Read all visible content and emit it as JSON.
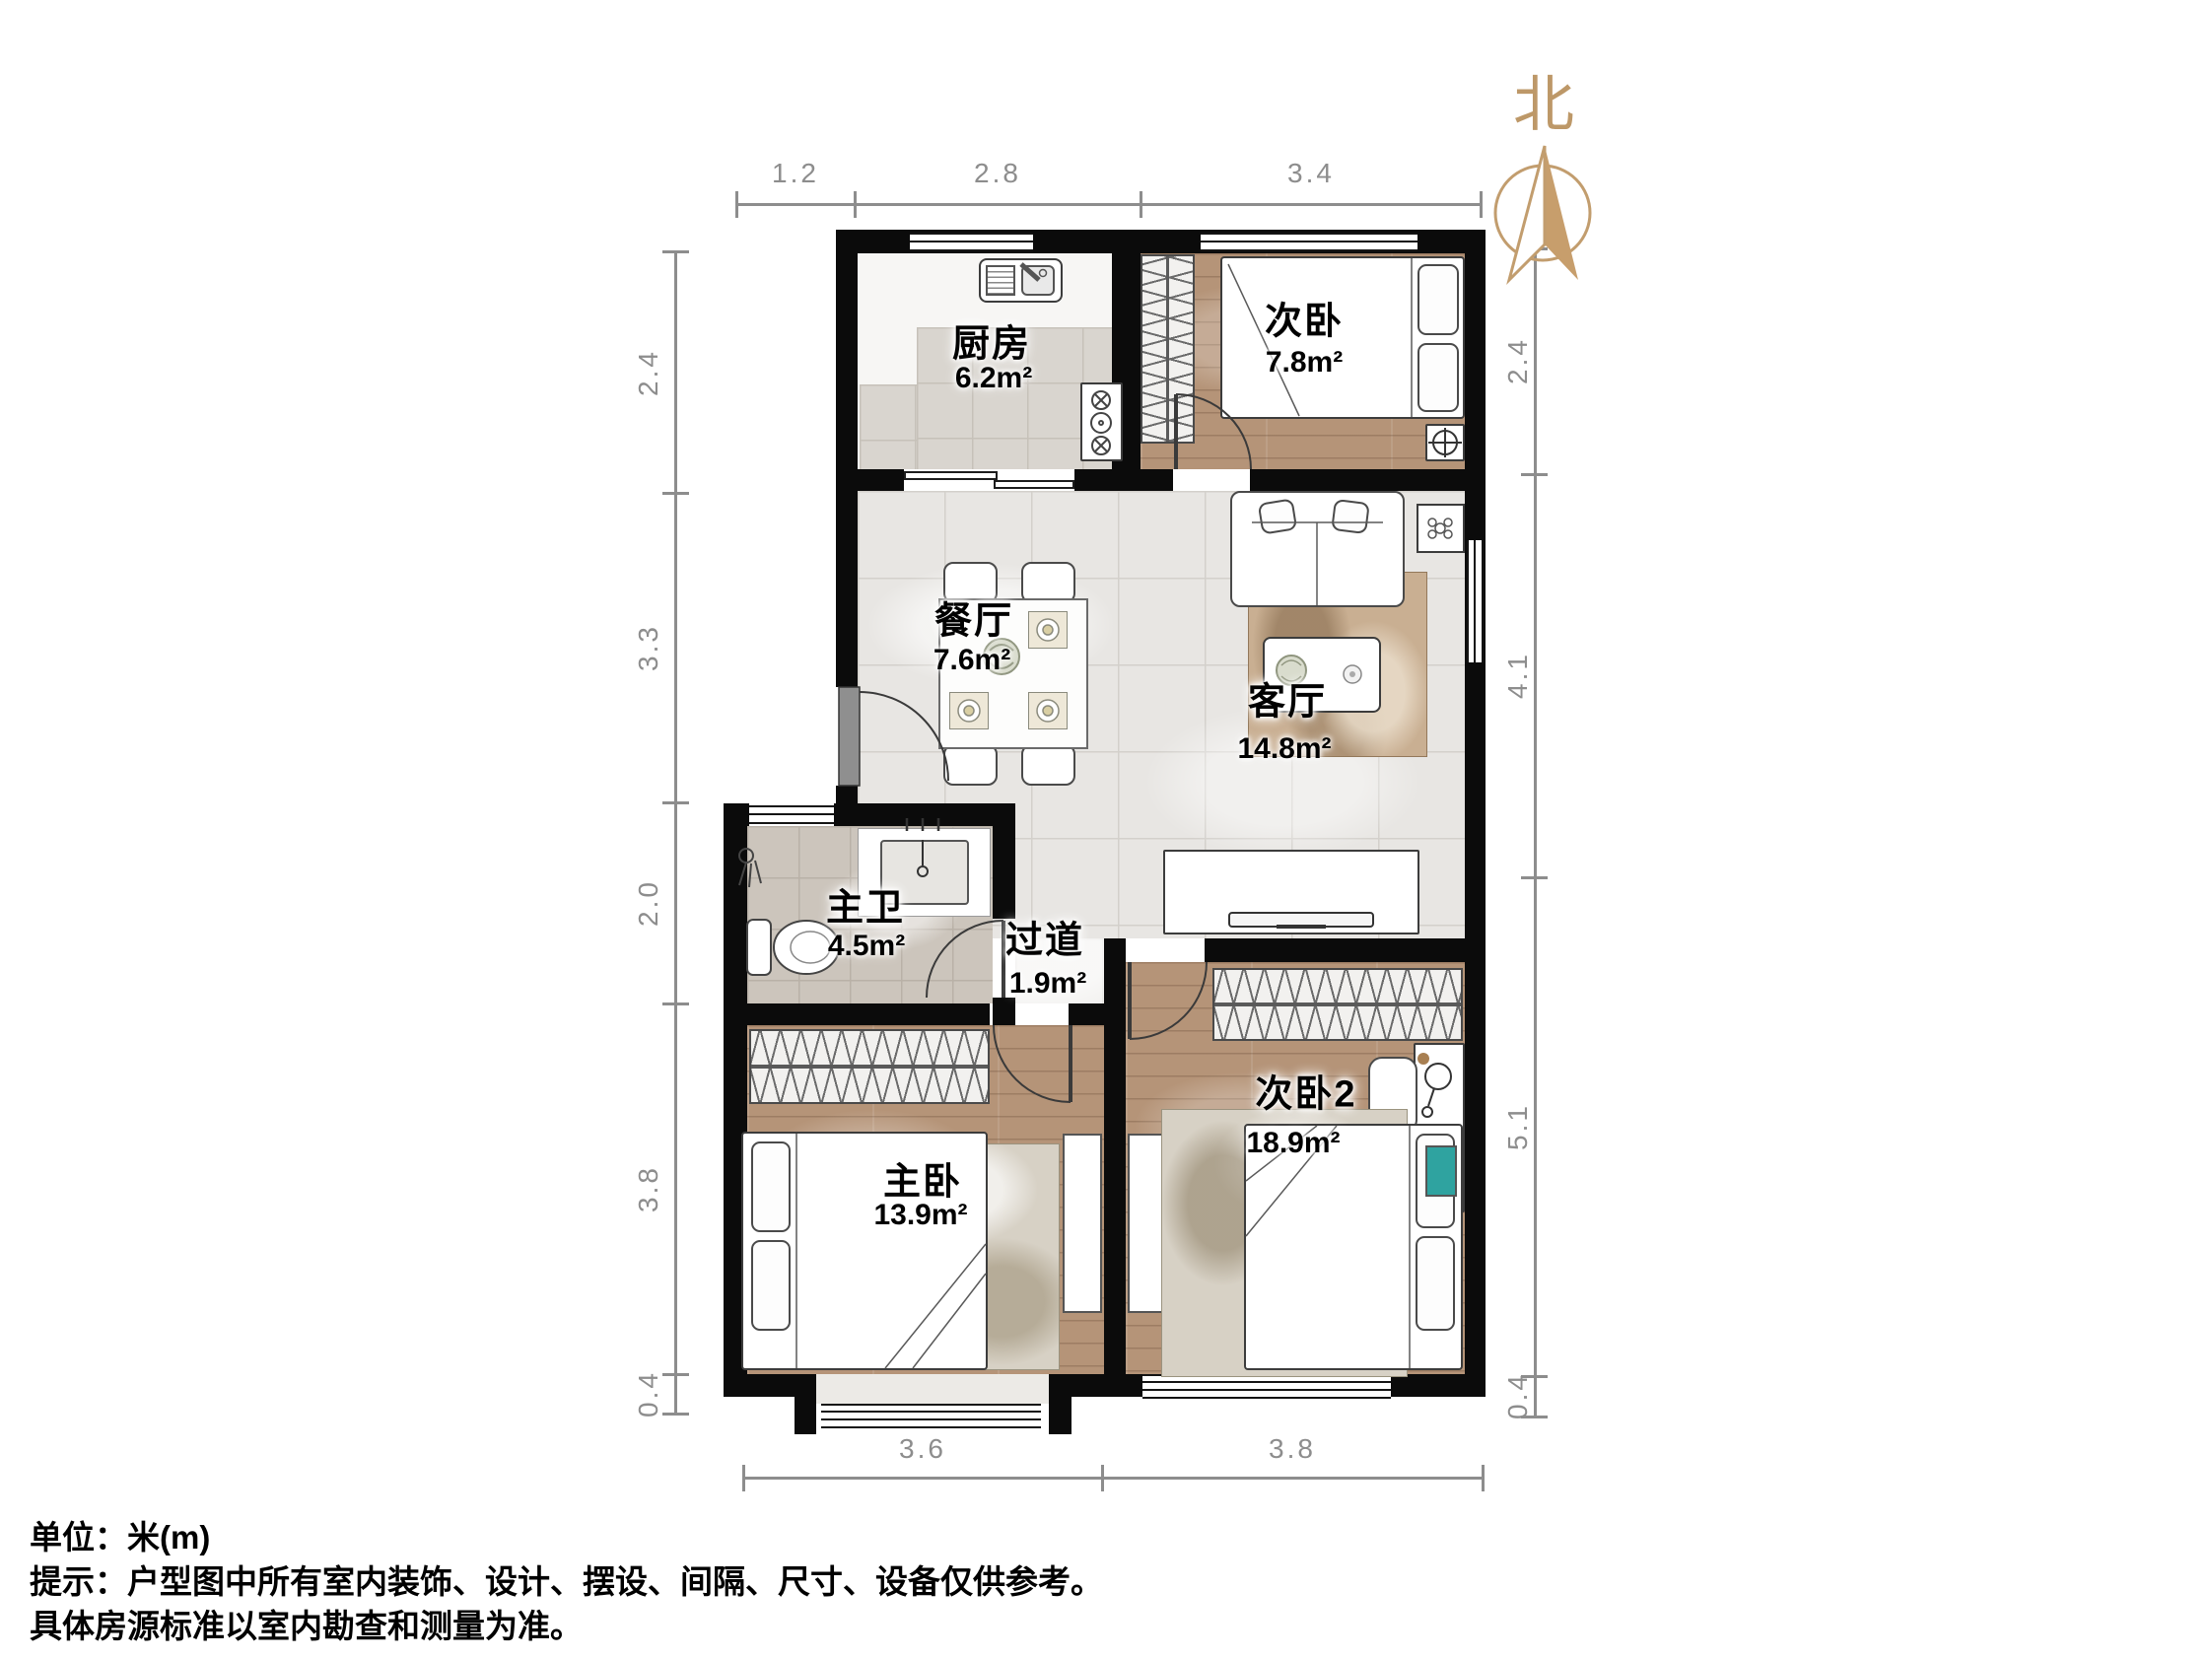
{
  "north_label": "北",
  "rooms": [
    {
      "id": "kitchen",
      "name": "厨房",
      "area": "6.2m²"
    },
    {
      "id": "bedroom2",
      "name": "次卧",
      "area": "7.8m²"
    },
    {
      "id": "dining",
      "name": "餐厅",
      "area": "7.6m²"
    },
    {
      "id": "living",
      "name": "客厅",
      "area": "14.8m²"
    },
    {
      "id": "master-bath",
      "name": "主卫",
      "area": "4.5m²"
    },
    {
      "id": "hallway",
      "name": "过道",
      "area": "1.9m²"
    },
    {
      "id": "master-bedroom",
      "name": "主卧",
      "area": "13.9m²"
    },
    {
      "id": "bedroom3",
      "name": "次卧2",
      "area": "18.9m²"
    }
  ],
  "dimensions": {
    "top": [
      "1.2",
      "2.8",
      "3.4"
    ],
    "bottom": [
      "3.6",
      "3.8"
    ],
    "left": [
      "2.4",
      "3.3",
      "2.0",
      "3.8",
      "0.4"
    ],
    "right": [
      "2.4",
      "4.1",
      "5.1",
      "0.4"
    ]
  },
  "footer": {
    "unit": "单位：米(m)",
    "tip_line1": "提示：户型图中所有室内装饰、设计、摆设、间隔、尺寸、设备仅供参考。",
    "tip_line2": "具体房源标准以室内勘查和测量为准。"
  },
  "colors": {
    "wall": "#0b0b0b",
    "wood": "#b59478",
    "tile": "#e8e6e3",
    "bath_tile": "#ccc5bc",
    "accent": "#bd9868",
    "dim_line": "#8d8d8d"
  }
}
